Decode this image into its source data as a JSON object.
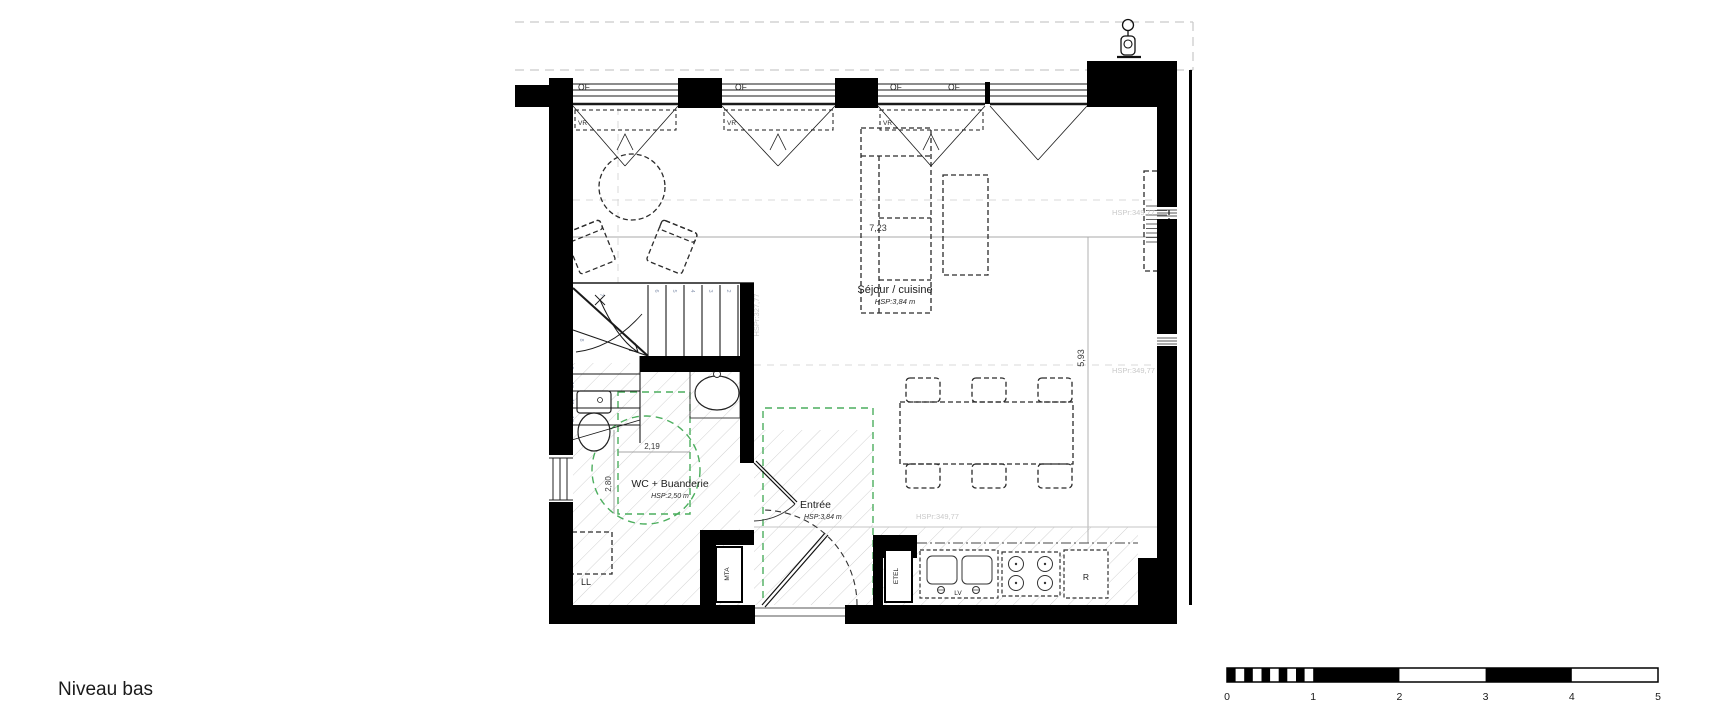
{
  "title": "Niveau bas",
  "colors": {
    "wall": "#000000",
    "green_annotation": "#4cae5e",
    "gray_annotation": "#c9c9c9",
    "hatch": "#d2d2d2"
  },
  "plan": {
    "rooms": {
      "sejour": {
        "name": "Séjour / cuisine",
        "hsp": "HSP:3,84 m"
      },
      "wc": {
        "name": "WC + Buanderie",
        "hsp": "HSP:2,50 m"
      },
      "entree": {
        "name": "Entrée",
        "hsp": "HSP:3,84 m"
      }
    },
    "windows": {
      "of": "OF",
      "vr": "VR"
    },
    "dims": {
      "d1": "7,23",
      "d2": "5,93",
      "d3": "2,19",
      "d4": "2,80"
    },
    "annot": {
      "a1": "HSPr:349,77",
      "a2": "HSPr:349,77",
      "a3": "HSPr:349,77",
      "a4": "HSPr:327,77"
    },
    "appliances": {
      "ll": "LL",
      "mta": "MTA",
      "etel": "ETEL",
      "r": "R",
      "lv": "LV"
    },
    "stairs": {
      "numbers": [
        "1",
        "2",
        "3",
        "4",
        "5",
        "6",
        "7",
        "8",
        "9",
        "10",
        "11",
        "12"
      ]
    }
  },
  "scalebar": {
    "labels": [
      "0",
      "1",
      "2",
      "3",
      "4",
      "5"
    ]
  }
}
